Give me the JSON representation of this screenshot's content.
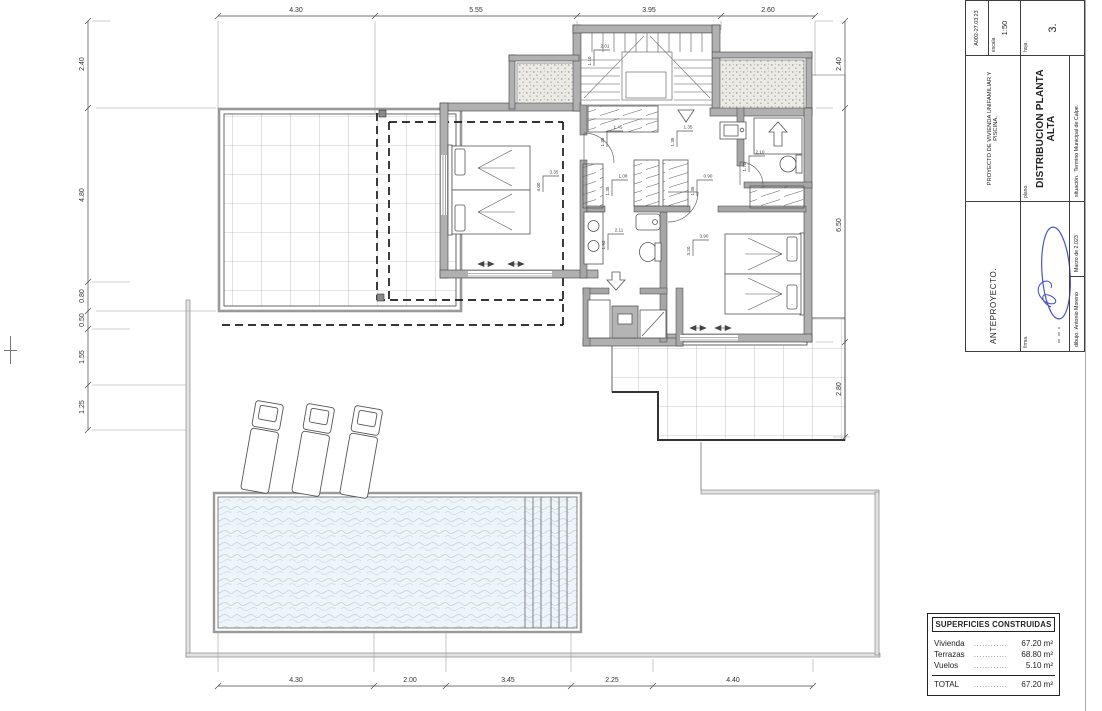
{
  "sheet": {
    "background": "#ffffff",
    "page_border_color": "#a8a8a8"
  },
  "drawing": {
    "wall_fill": "#b0b0b0",
    "line_color": "#3f3f3f",
    "tile_line_color": "#9b9b9b",
    "water_fill": "#eef5f9",
    "wave_color": "#bcd2e0",
    "dashed_overhang_color": "#1a1a1a",
    "signature_color": "#4a55c9"
  },
  "dimensions": {
    "top": [
      "4.30",
      "5.55",
      "3.95",
      "2.60"
    ],
    "bottom": [
      "4.30",
      "2.00",
      "3.45",
      "2.25",
      "4.40"
    ],
    "left": [
      "2.40",
      "4.80",
      "0.80",
      "0.50",
      "1.55",
      "1.25"
    ],
    "right": [
      "2.40",
      "6.50",
      "2.80"
    ]
  },
  "room_labels": [
    {
      "w": "3.35",
      "h": "4.00"
    },
    {
      "w": "1.45",
      "h": "1.35"
    },
    {
      "w": "1.35",
      "h": "1.35"
    },
    {
      "w": "1.08",
      "h": "1.35"
    },
    {
      "w": "0.90",
      "h": "1.35"
    },
    {
      "w": "2.11",
      "h": "1.93"
    },
    {
      "w": "2.10",
      "h": "1.70"
    },
    {
      "w": "3.90",
      "h": "3.20"
    },
    {
      "w": "2.01",
      "h": "1.10"
    }
  ],
  "title_block": {
    "project_type": "ANTEPROYECTO.",
    "ref": "A002-27.03.23",
    "project_label": "PROYECTO DE VIVIENDA UNIFAMILIAR Y PISCINA.",
    "scale_label": "escala",
    "scale_value": "1:50",
    "plan_label": "plano.",
    "plan_title": "DISTRIBUCION PLANTA ALTA",
    "sheet_label": "hoja.",
    "sheet_number": "3.",
    "location_label": "situación.",
    "location_value": "Termino Municipal de Calpe.",
    "signature_label": "firma.",
    "author_label": "dibujo.",
    "author_value": "Antonio Moreno",
    "date_value": "Marzo de 2.023"
  },
  "areas_table": {
    "title": "SUPERFICIES CONSTRUIDAS",
    "rows": [
      {
        "label": "Vivienda",
        "leader": "............",
        "value": "67.20 m²"
      },
      {
        "label": "Terrazas",
        "leader": "............",
        "value": "68.80 m²"
      },
      {
        "label": "Vuelos",
        "leader": "............",
        "value": "5.10 m²"
      }
    ],
    "total": {
      "label": "TOTAL",
      "leader": "............",
      "value": "67.20 m²"
    }
  }
}
